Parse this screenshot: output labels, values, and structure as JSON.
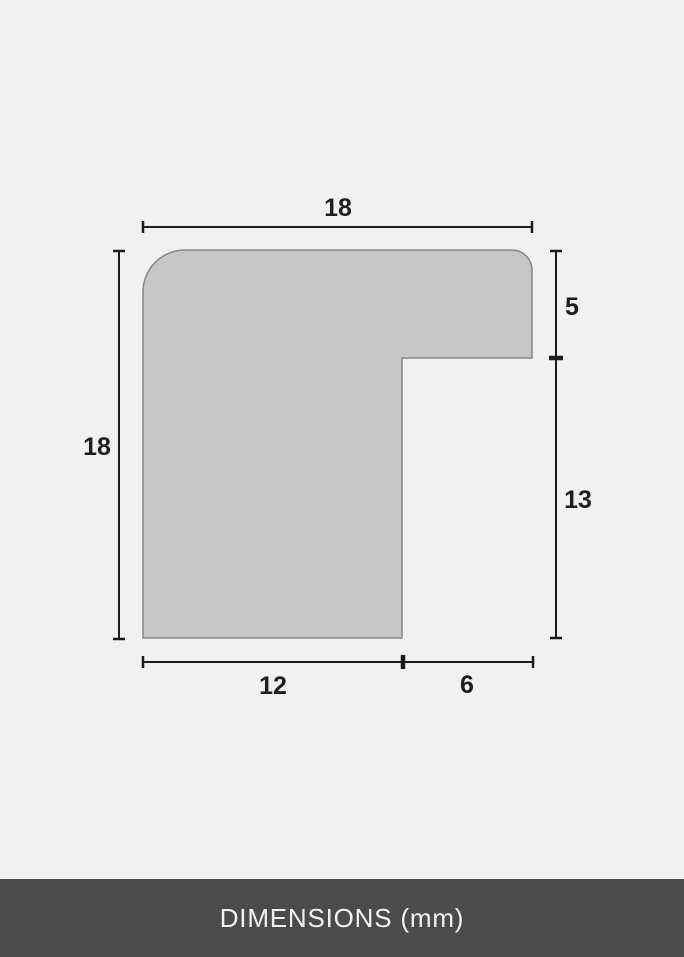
{
  "diagram": {
    "type": "frame-moulding-cross-section",
    "unit": "mm",
    "dimensions": {
      "top_width": "18",
      "left_height": "18",
      "right_upper_height": "5",
      "right_lower_height": "13",
      "bottom_inner_width": "12",
      "bottom_outer_width": "6"
    },
    "colors": {
      "background": "#f1f1f1",
      "shape_fill": "#c7c7c7",
      "shape_outline": "#858585",
      "dimension_line": "#1c1c1c",
      "label_text": "#1e1e1e",
      "footer_background": "#4b4b4b",
      "footer_text": "#f2f2f2"
    }
  },
  "footer": {
    "label": "DIMENSIONS (mm)"
  }
}
